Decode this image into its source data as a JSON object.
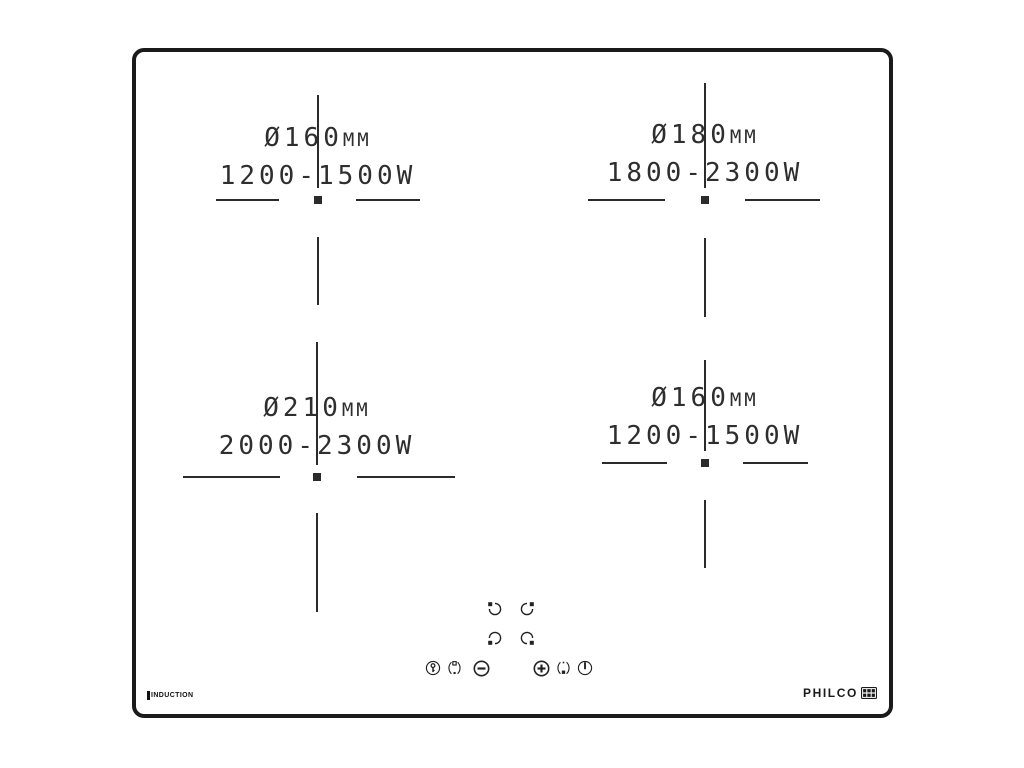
{
  "title": "Induction hob layout diagram",
  "brand": {
    "logo_text": "PHILCO",
    "type_label": "INDUCTION"
  },
  "zones": [
    {
      "position": "top-left",
      "diameter": "Ø160",
      "unit": "MM",
      "power": "1200-1500W"
    },
    {
      "position": "top-right",
      "diameter": "Ø180",
      "unit": "MM",
      "power": "1800-2300W"
    },
    {
      "position": "bottom-left",
      "diameter": "Ø210",
      "unit": "MM",
      "power": "2000-2300W"
    },
    {
      "position": "bottom-right",
      "diameter": "Ø160",
      "unit": "MM",
      "power": "1200-1500W"
    }
  ],
  "controls": {
    "zone_selectors": [
      {
        "icon": "zone-select-top-left-icon"
      },
      {
        "icon": "zone-select-top-right-icon"
      },
      {
        "icon": "zone-select-bottom-left-icon"
      },
      {
        "icon": "zone-select-bottom-right-icon"
      }
    ],
    "buttons": [
      {
        "icon": "child-lock-icon"
      },
      {
        "icon": "timer-left-icon"
      },
      {
        "icon": "minus-icon"
      },
      {
        "icon": "plus-icon"
      },
      {
        "icon": "timer-right-icon"
      },
      {
        "icon": "power-icon"
      }
    ]
  },
  "colors": {
    "line": "#2b2b2b",
    "panel_border": "#1a1a1a",
    "background": "#ffffff"
  }
}
